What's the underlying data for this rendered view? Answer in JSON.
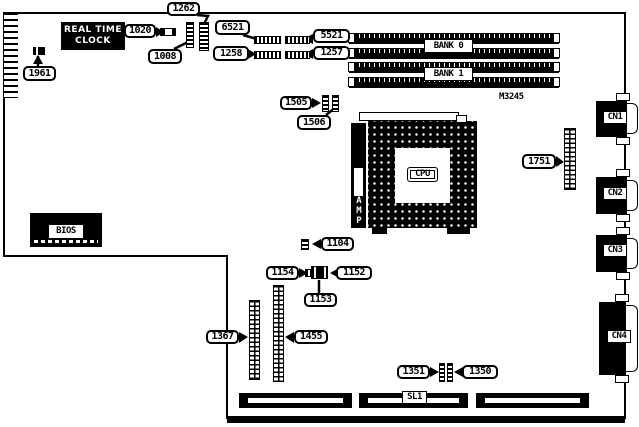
{
  "figure": {
    "model_number": "M3245"
  },
  "components": {
    "rtc_line1": "REAL TIME",
    "rtc_line2": "CLOCK",
    "bios": "BIOS",
    "cpu": "CPU",
    "amp": "AMP",
    "bank0": "BANK 0",
    "bank1": "BANK 1",
    "sl1": "SL1",
    "cn1": "CN1",
    "cn2": "CN2",
    "cn3": "CN3",
    "cn4": "CN4"
  },
  "callouts": {
    "c1262": "1262",
    "c6521": "6521",
    "c5521": "5521",
    "c1020": "1020",
    "c1008": "1008",
    "c1258": "1258",
    "c1257": "1257",
    "c1961": "1961",
    "c1505": "1505",
    "c1506": "1506",
    "c1751": "1751",
    "c1104": "1104",
    "c1154": "1154",
    "c1152": "1152",
    "c1153": "1153",
    "c1367": "1367",
    "c1455": "1455",
    "c1351": "1351",
    "c1350": "1350"
  },
  "colors": {
    "ink": "#000000",
    "paper": "#ffffff"
  }
}
